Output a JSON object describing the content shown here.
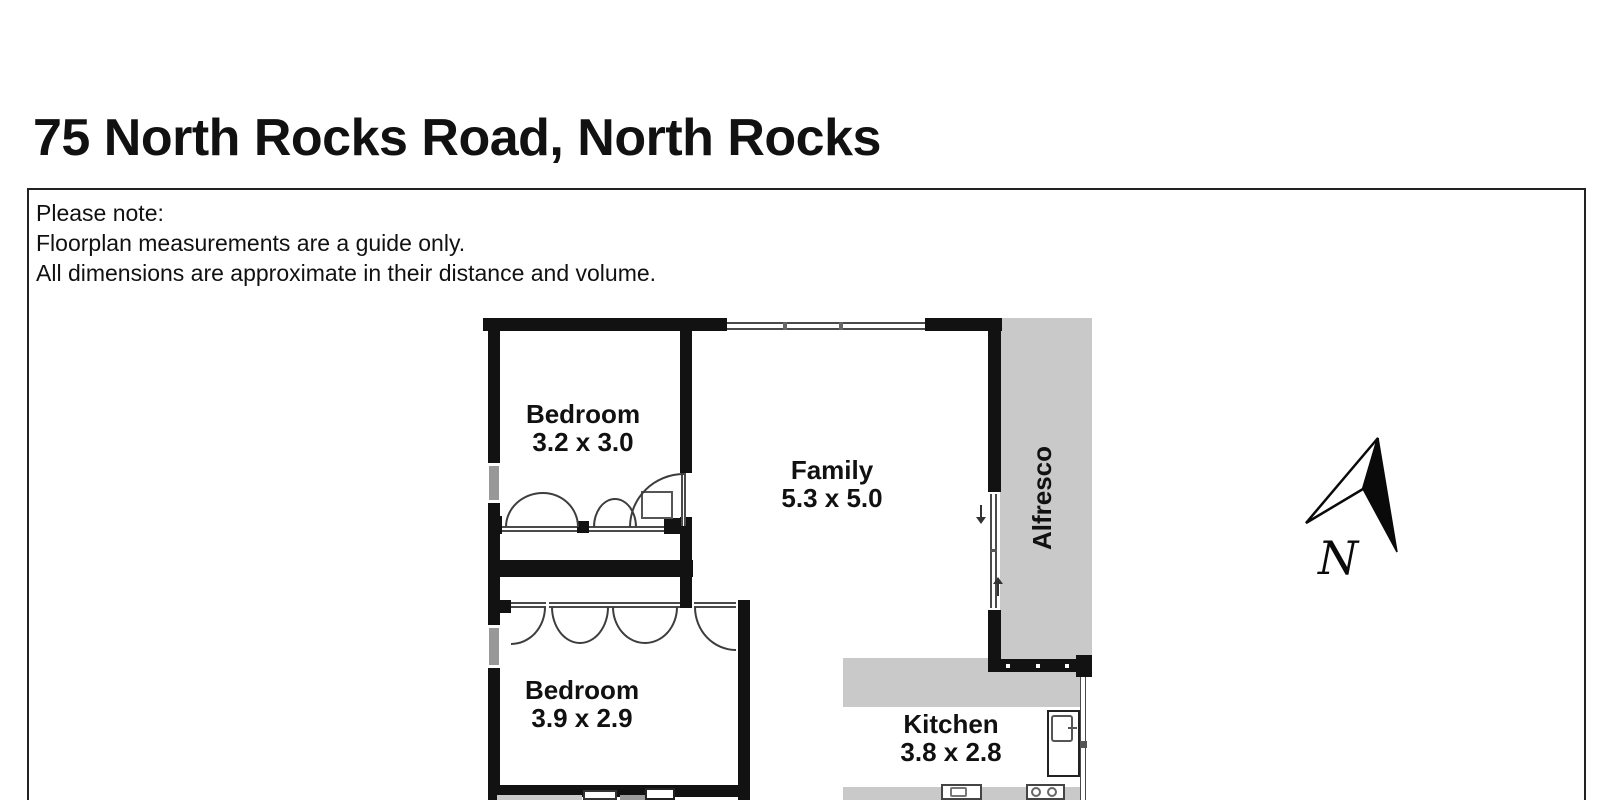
{
  "page": {
    "title": "75 North Rocks Road, North Rocks"
  },
  "note": {
    "line1": "Please note:",
    "line2": "Floorplan measurements are a guide only.",
    "line3": "All dimensions are approximate in their distance and volume."
  },
  "floorplan": {
    "rooms": {
      "bedroom1": {
        "name": "Bedroom",
        "dims": "3.2 x 3.0"
      },
      "family": {
        "name": "Family",
        "dims": "5.3 x 5.0"
      },
      "alfresco": {
        "name": "Alfresco"
      },
      "bedroom2": {
        "name": "Bedroom",
        "dims": "3.9 x 2.9"
      },
      "kitchen": {
        "name": "Kitchen",
        "dims": "3.8 x 2.8"
      }
    },
    "compass": {
      "label": "N"
    },
    "colors": {
      "wall": "#121212",
      "outdoor_gray": "#c9c9c9",
      "counter_gray": "#c9c9c9",
      "window_line": "#4a4a4a"
    }
  }
}
